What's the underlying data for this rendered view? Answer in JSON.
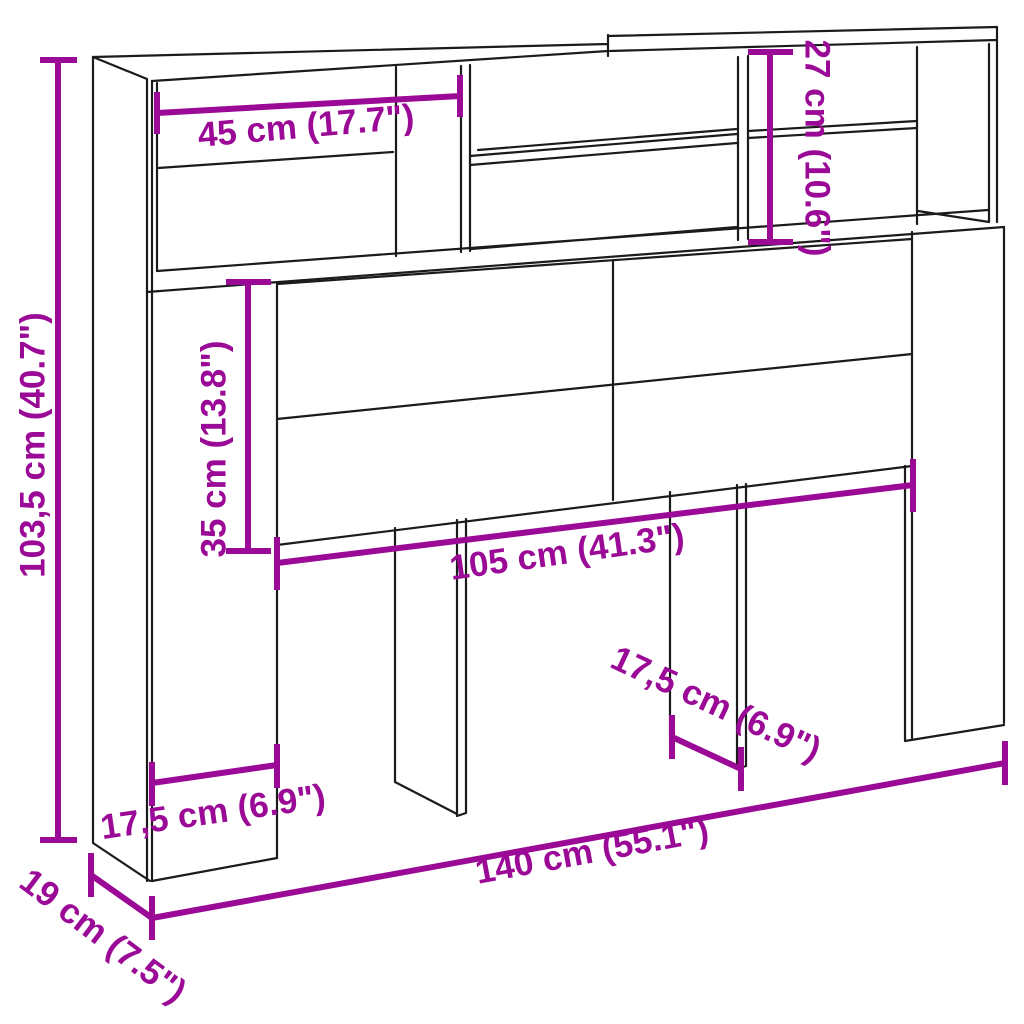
{
  "figure": {
    "background_color": "#ffffff",
    "outline_color": "#1b1b1b",
    "dimension_color": "#9b0a96",
    "dimensions": {
      "height": "103,5 cm (40.7\")",
      "shelf_width": "45 cm (17.7\")",
      "top_section_height": "27 cm (10.6\")",
      "panel_height": "35 cm (13.8\")",
      "inner_width": "105 cm (41.3\")",
      "left_leg_width": "17,5 cm (6.9\")",
      "middle_leg_depth": "17,5 cm (6.9\")",
      "total_width": "140 cm (55.1\")",
      "depth": "19 cm (7.5\")"
    }
  }
}
